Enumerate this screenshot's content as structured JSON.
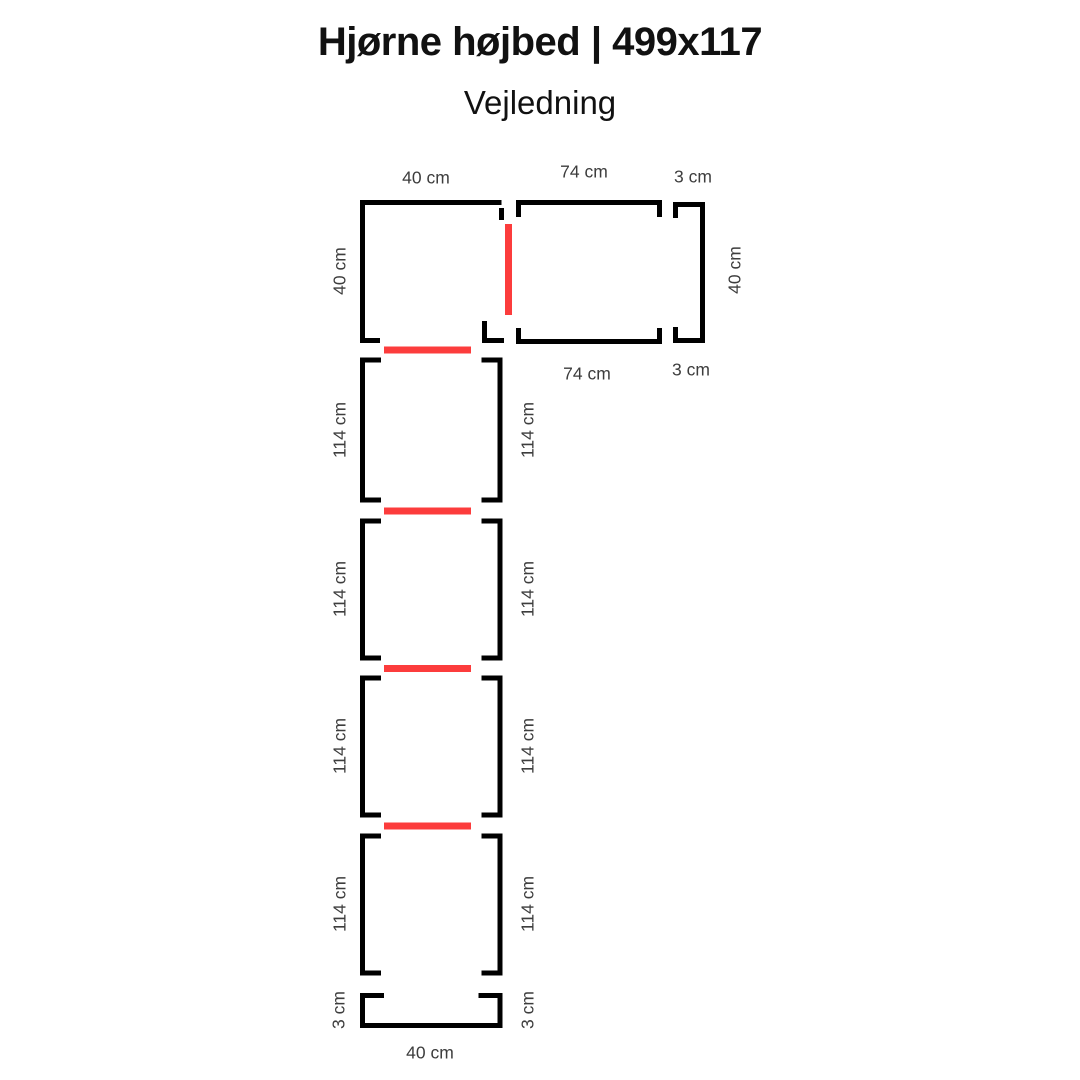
{
  "header": {
    "title": "Hjørne højbed | 499x117",
    "subtitle": "Vejledning"
  },
  "colors": {
    "line": "#000000",
    "connector_red": "#fc3c3c",
    "label_text": "#3d3d3d",
    "title_text": "#111111",
    "background": "#ffffff"
  },
  "diagram": {
    "square": {
      "top": "40 cm",
      "left": "40 cm"
    },
    "long_section": {
      "top": "74 cm",
      "bottom": "74 cm"
    },
    "right_cap": {
      "top": "3 cm",
      "bottom": "3 cm",
      "side": "40 cm"
    },
    "column_sections": [
      {
        "left": "114 cm",
        "right": "114 cm"
      },
      {
        "left": "114 cm",
        "right": "114 cm"
      },
      {
        "left": "114 cm",
        "right": "114 cm"
      },
      {
        "left": "114 cm",
        "right": "114 cm"
      }
    ],
    "bottom_cap": {
      "left": "3 cm",
      "right": "3 cm",
      "bottom": "40 cm"
    }
  }
}
